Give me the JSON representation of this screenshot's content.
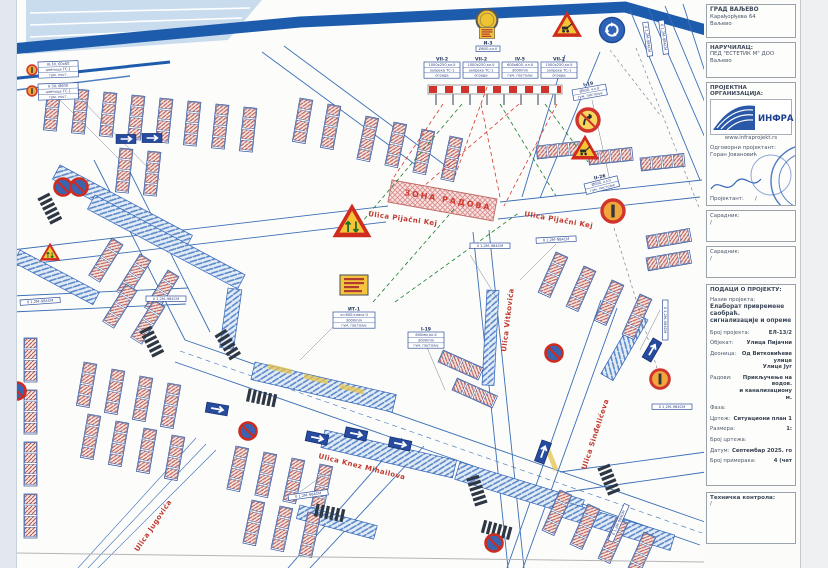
{
  "title_block": {
    "owner_line1": "ГРАД ВАЉЕВО",
    "owner_line2": "Карађорђева 64",
    "owner_line3": "Ваљево",
    "client_label": "НАРУЧИЛАЦ:",
    "client_line1": "ПЕД \"ЕСТЕТИК М\" ДОО",
    "client_line2": "Ваљево",
    "org_label": "ПРОЈЕКТНА ОРГАНИЗАЦИЈА:",
    "org_logo_text": "ИНФРА про",
    "org_url": "www.infraprojekt.rs",
    "responsible_label": "Одговорни пројектант:",
    "responsible_name": "Горан Јовановић",
    "designer_label": "Пројектант:",
    "designer_value": "/",
    "collab1_label": "Сарадник:",
    "collab1_value": "/",
    "collab2_label": "Сарадник:",
    "collab2_value": "/",
    "project_data_label": "ПОДАЦИ О ПРОЈЕКТУ:",
    "project_name_label": "Назив пројекта:",
    "project_name_1": "Елаборат привремене саобраћ.",
    "project_name_2": "сигнализације и опреме",
    "rows": [
      {
        "label": "Број пројекта:",
        "value": "ЕЛ-13/2"
      },
      {
        "label": "Објекат:",
        "value": "Улица Пијачни"
      },
      {
        "label": "Деоница:",
        "value": "Од Витковићеве улице",
        "value2": "Улице Југ"
      },
      {
        "label": "Радови:",
        "value": "Прикључење на водов.",
        "value2": "и канализациону м."
      },
      {
        "label": "Фаза:",
        "value": ""
      },
      {
        "label": "Цртеж:",
        "value": "Ситуациони план 1"
      },
      {
        "label": "Размера:",
        "value": "1:"
      },
      {
        "label": "Број цртежа:",
        "value": ""
      },
      {
        "label": "Датум:",
        "value": "Септембар 2025. го"
      },
      {
        "label": "Број примерака:",
        "value": "4 (чет"
      }
    ],
    "tech_control_label": "Техничка контрола:",
    "tech_control_value": "/"
  },
  "map": {
    "work_zone_label": "ЗОНА РАДОВА",
    "street_labels": [
      {
        "text": "Ulica Pijačni Kej",
        "x": 368,
        "y": 216,
        "r": 8
      },
      {
        "text": "Ulica Pijačni Kej",
        "x": 524,
        "y": 216,
        "r": 10
      },
      {
        "text": "Ulica Vitkovića",
        "x": 506,
        "y": 352,
        "r": -83
      },
      {
        "text": "Ulica Knez Mihailova",
        "x": 318,
        "y": 458,
        "r": 14
      },
      {
        "text": "Ulica Jugovića",
        "x": 138,
        "y": 552,
        "r": -56
      },
      {
        "text": "Ulica Sinđelićeva",
        "x": 586,
        "y": 470,
        "r": -72
      }
    ],
    "sign_tables": [
      {
        "x": 424,
        "y": 62,
        "r": 0,
        "w": 36,
        "header": "VII-2",
        "rows": [
          "1000x250,кл.II",
          "запрека ТС-1",
          "ограда"
        ]
      },
      {
        "x": 463,
        "y": 62,
        "r": 0,
        "w": 36,
        "header": "VII-2",
        "rows": [
          "1000x250,кл.II",
          "запрека ТС-1",
          "ограда"
        ]
      },
      {
        "x": 502,
        "y": 62,
        "r": 0,
        "w": 36,
        "header": "IV-5",
        "rows": [
          "600x600, кл.II",
          "3000mm",
          "гум. постоље"
        ]
      },
      {
        "x": 541,
        "y": 62,
        "r": 0,
        "w": 36,
        "header": "VII-2",
        "rows": [
          "1000x250,кл.II",
          "запрека ТС-1",
          "ограда"
        ]
      },
      {
        "x": 476,
        "y": 46,
        "r": 0,
        "w": 24,
        "header": "И-3",
        "rows": [
          "Ø600,кл.II"
        ]
      },
      {
        "x": 333,
        "y": 312,
        "r": 0,
        "w": 42,
        "header": "ИТ-1",
        "rows": [
          "а=600,класа II",
          "3000mm",
          "гум. постоље"
        ]
      },
      {
        "x": 572,
        "y": 90,
        "r": -10,
        "w": 34,
        "header": "I-19",
        "rows": [
          "Ø600, кл.II",
          "гум. постоље"
        ]
      },
      {
        "x": 408,
        "y": 332,
        "r": 0,
        "w": 36,
        "header": "I-19",
        "rows": [
          "600мм,кл.II",
          "3000mm",
          "гум. постоље"
        ]
      },
      {
        "x": 584,
        "y": 184,
        "r": -14,
        "w": 34,
        "header": "II-26",
        "rows": [
          "Ø600, кл.II",
          "гум. постоље"
        ]
      },
      {
        "x": 38,
        "y": 62,
        "r": -2,
        "w": 40,
        "rows": [
          "III-30, 60x60",
          "цевчица ТС-1",
          "гум. пост."
        ]
      },
      {
        "x": 38,
        "y": 84,
        "r": -2,
        "w": 40,
        "rows": [
          "II-30, Ø600",
          "цевчица ТС-1",
          "гум. пост."
        ]
      },
      {
        "x": 20,
        "y": 300,
        "r": -4,
        "w": 40,
        "rows": [
          "0 1,2М–984СМ"
        ]
      },
      {
        "x": 146,
        "y": 296,
        "r": 0,
        "w": 40,
        "rows": [
          "0 1,2М–984СМ"
        ]
      },
      {
        "x": 536,
        "y": 238,
        "r": -3,
        "w": 40,
        "rows": [
          "0 1,2М–984СМ"
        ]
      },
      {
        "x": 470,
        "y": 243,
        "r": 0,
        "w": 40,
        "rows": [
          "0 1,2М–984СМ"
        ]
      },
      {
        "x": 668,
        "y": 300,
        "r": 90,
        "w": 40,
        "rows": [
          "0 1,2М–984СМ"
        ]
      },
      {
        "x": 652,
        "y": 404,
        "r": 0,
        "w": 40,
        "rows": [
          "0 1,2М–984СМ"
        ]
      },
      {
        "x": 648,
        "y": 22,
        "r": 82,
        "w": 34,
        "rows": [
          "0 1,2М–984СМ"
        ]
      },
      {
        "x": 664,
        "y": 20,
        "r": 82,
        "w": 34,
        "rows": [
          "0 1,2М–984СМ"
        ]
      },
      {
        "x": 288,
        "y": 495,
        "r": -8,
        "w": 40,
        "rows": [
          "0 1,2М–984СМ"
        ]
      },
      {
        "x": 608,
        "y": 540,
        "r": -66,
        "w": 40,
        "rows": [
          "0 1,2М–984СМ"
        ]
      }
    ],
    "signs": [
      {
        "type": "sign-beacon",
        "x": 487,
        "y": 20,
        "s": 0.8
      },
      {
        "type": "sign-infoboard",
        "x": 487,
        "y": 33,
        "s": 0.55
      },
      {
        "type": "sign-tri-works",
        "x": 567,
        "y": 26,
        "s": 1.15
      },
      {
        "type": "sign-circ-round",
        "x": 612,
        "y": 30,
        "s": 1
      },
      {
        "type": "sign-tri-pass",
        "x": 352,
        "y": 223,
        "s": 1.5
      },
      {
        "type": "sign-tri-works",
        "x": 585,
        "y": 149,
        "s": 1.1
      },
      {
        "type": "sign-circ-turn",
        "x": 588,
        "y": 120,
        "s": 1
      },
      {
        "type": "sign-circ-bar",
        "x": 613,
        "y": 211,
        "s": 1
      },
      {
        "type": "sign-circ-bar",
        "x": 660,
        "y": 379,
        "s": 0.85
      },
      {
        "type": "sign-infoboard",
        "x": 354,
        "y": 285,
        "s": 1
      },
      {
        "type": "sign-tri-pass",
        "x": 50,
        "y": 253,
        "s": 0.8
      },
      {
        "type": "sign-circ-nostop",
        "x": 63,
        "y": 187,
        "s": 1
      },
      {
        "type": "sign-circ-nostop",
        "x": 79,
        "y": 187,
        "s": 1
      },
      {
        "type": "sign-circ-nostop",
        "x": 554,
        "y": 353,
        "s": 1
      },
      {
        "type": "sign-circ-nostop",
        "x": 494,
        "y": 543,
        "s": 1
      },
      {
        "type": "sign-circ-nostop",
        "x": 248,
        "y": 431,
        "s": 1
      },
      {
        "type": "sign-circ-nostop",
        "x": 17,
        "y": 391,
        "s": 1
      },
      {
        "type": "sign-circ-bar",
        "x": 32,
        "y": 70,
        "s": 0.45
      },
      {
        "type": "sign-circ-bar",
        "x": 32,
        "y": 91,
        "s": 0.45
      },
      {
        "type": "sign-rect-arrow",
        "x": 126,
        "y": 139,
        "s": 0.9
      },
      {
        "type": "sign-rect-arrow",
        "x": 152,
        "y": 138,
        "s": 0.9
      },
      {
        "type": "sign-rect-arrow",
        "x": 217,
        "y": 409,
        "r": 10,
        "s": 1
      },
      {
        "type": "sign-rect-arrow",
        "x": 317,
        "y": 438,
        "r": 12,
        "s": 1
      },
      {
        "type": "sign-rect-arrow",
        "x": 356,
        "y": 434,
        "r": 12,
        "s": 1
      },
      {
        "type": "sign-rect-arrow",
        "x": 400,
        "y": 444,
        "r": 12,
        "s": 1
      },
      {
        "type": "sign-rect-arrow",
        "x": 652,
        "y": 350,
        "r": -60,
        "s": 1
      },
      {
        "type": "sign-rect-arrow",
        "x": 543,
        "y": 452,
        "r": -70,
        "s": 1
      }
    ]
  }
}
